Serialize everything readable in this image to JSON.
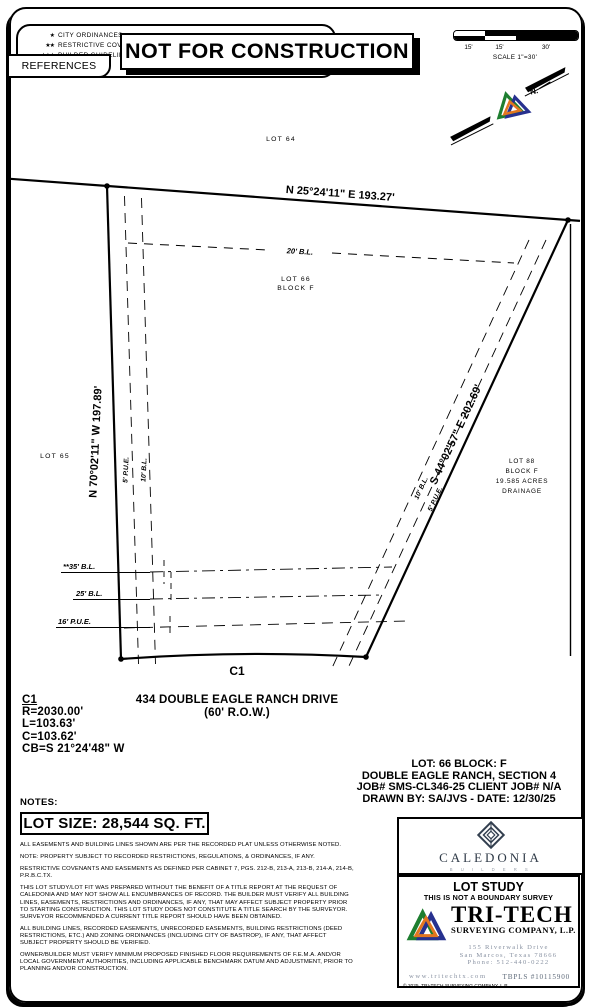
{
  "legend": {
    "items": [
      {
        "stars": "★",
        "label": "CITY ORDINANCES"
      },
      {
        "stars": "★★",
        "label": "RESTRICTIVE COVENANTS"
      },
      {
        "stars": "★★★",
        "label": "BUILDER GUIDELINES"
      }
    ],
    "tab": "REFERENCES"
  },
  "banner": "NOT FOR CONSTRUCTION",
  "scale_bar": {
    "labels": [
      "15'",
      "15'",
      "30'"
    ],
    "caption": "SCALE 1\"=30'"
  },
  "north_arrow": {
    "label": "N."
  },
  "drawing": {
    "lot64": "LOT  64",
    "lot65": "LOT  65",
    "bearing_top": "N 25°24'11\" E  193.27'",
    "bearing_left": "N 70°02'11\" W  197.89'",
    "bearing_right": "S 44°02'57\" E  202.69'",
    "bl20": "20' B.L.",
    "lot66_line1": "LOT  66",
    "lot66_line2": "BLOCK  F",
    "pue5_left": "5' P.U.E.",
    "bl10_left": "10' B.L.",
    "bl10_right": "10' B.L.",
    "pue5_right": "5' P.U.E.",
    "bl35": "**35' B.L.",
    "bl25": "25' B.L.",
    "pue16": "16' P.U.E.",
    "c1_label": "C1",
    "lot88_line1": "LOT  88",
    "lot88_line2": "BLOCK  F",
    "lot88_line3": "19.585  ACRES",
    "lot88_line4": "DRAINAGE",
    "street_line1": "434 DOUBLE EAGLE RANCH DRIVE",
    "street_line2": "(60' R.O.W.)"
  },
  "curve_table": {
    "name": "C1",
    "radius": "R=2030.00'",
    "length": "L=103.63'",
    "chord": "C=103.62'",
    "chord_bearing": "CB=S 21°24'48\" W"
  },
  "job": {
    "line1": "LOT: 66   BLOCK: F",
    "line2": "DOUBLE EAGLE RANCH, SECTION 4",
    "line3": "JOB# SMS-CL346-25 CLIENT JOB# N/A",
    "line4": "DRAWN BY: SA/JVS - DATE: 12/30/25"
  },
  "notes": {
    "header": "NOTES:",
    "lot_size": "LOT SIZE: 28,544 SQ. FT.",
    "paragraphs": [
      "ALL EASEMENTS AND BUILDING LINES SHOWN ARE PER THE RECORDED PLAT UNLESS OTHERWISE NOTED.",
      "NOTE: PROPERTY SUBJECT TO RECORDED RESTRICTIONS, REGULATIONS, & ORDINANCES, IF ANY.",
      "RESTRICTIVE COVENANTS AND EASEMENTS AS DEFINED PER CABINET 7, PGS. 212-B, 213-A, 213-B, 214-A, 214-B, P.R.B.C.TX.",
      "THIS LOT STUDY/LOT FIT WAS PREPARED WITHOUT THE BENEFIT OF A TITLE REPORT AT THE REQUEST OF CALEDONIA AND MAY NOT SHOW ALL ENCUMBRANCES OF RECORD.  THE BUILDER MUST VERIFY ALL BUILDING LINES, EASEMENTS, RESTRICTIONS AND ORDINANCES, IF ANY, THAT MAY AFFECT SUBJECT PROPERTY PRIOR TO STARTING CONSTRUCTION.  THIS LOT STUDY DOES NOT CONSTITUTE A TITLE SEARCH BY THE SURVEYOR. SURVEYOR RECOMMENDED A CURRENT TITLE REPORT SHOULD HAVE BEEN OBTAINED.",
      "ALL BUILDING LINES, RECORDED EASEMENTS, UNRECORDED EASEMENTS, BUILDING RESTRICTIONS (DEED RESTRICTIONS, ETC.) AND ZONING ORDINANCES (INCLUDING CITY OF BASTROP), IF ANY,  THAT AFFECT SUBJECT PROPERTY SHOULD BE VERIFIED.",
      "OWNER/BUILDER MUST VERIFY MINIMUM PROPOSED FINISHED FLOOR REQUIREMENTS OF F.E.M.A. AND/OR LOCAL GOVERNMENT AUTHORITIES, INCLUDING APPLICABLE BENCHMARK DATUM AND ADJUSTMENT, PRIOR TO PLANNING AND/OR CONSTRUCTION."
    ]
  },
  "caledonia": {
    "name": "CALEDONIA",
    "sub": "B U I L D E R S"
  },
  "tritech": {
    "title": "LOT STUDY",
    "subtitle": "THIS IS NOT A BOUNDARY SURVEY",
    "name": "TRI-TECH",
    "company": "SURVEYING COMPANY, L.P.",
    "address_line1": "155 Riverwalk Drive",
    "address_line2": "San Marcos, Texas 78666",
    "address_line3": "Phone: 512-440-0222",
    "website": "www.tritechtx.com",
    "license": "TBPLS #10115900",
    "copyright": "© 2025, TRI-TECH SURVEYING COMPANY, L.P."
  },
  "colors": {
    "logo_green": "#1e7e30",
    "logo_navy": "#27318f",
    "logo_orange": "#e2761f",
    "brand_slate": "#333f4f",
    "muted_blue": "#8a93a3",
    "ink": "#000000"
  }
}
